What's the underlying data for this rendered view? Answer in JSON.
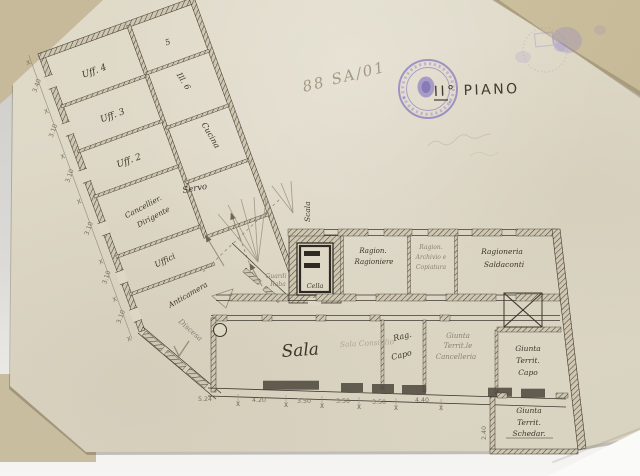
{
  "photo": {
    "backdrop": "#d4d2ce",
    "paper": "#ddd7c6",
    "backing": "#c7ba9a",
    "stamp_color": "#7e6fc2",
    "ink_color": "#3e3930",
    "pencil_color": "#8b8271"
  },
  "annotations": {
    "floor_title": "II° PIANO",
    "pencil_number": "88 SA/01",
    "tick": "X"
  },
  "plan": {
    "left_wing": {
      "rooms_left": [
        "Uff. 4",
        "Uff. 3",
        "Uff. 2"
      ],
      "office_room": {
        "line1": "Cancellier.",
        "line2": "Dirigente"
      },
      "offices_label": "Uffici",
      "anteroom_label": "Anticamera",
      "rooms_right": {
        "r1": "5",
        "r2": "Ill. 6",
        "r3": "Cucina",
        "r4": "Servo"
      },
      "dimensions": [
        "3.40",
        "3.10",
        "3.10",
        "3.10",
        "3.10",
        "3.10"
      ]
    },
    "center": {
      "stairs": "Scala",
      "cell": "Cella",
      "wardrobe1": "Guardi",
      "wardrobe2": "Roba",
      "descent": "Discesa"
    },
    "accounting": {
      "room1": {
        "line1": "Ragion.",
        "line2": "Ragioniere"
      },
      "room2": {
        "line1": "Ragion.",
        "line2": "Archivio e",
        "line3": "Copiatura"
      },
      "room3": {
        "line1": "Ragioneria",
        "line2": "Saldaconti"
      }
    },
    "hall": {
      "name": "Sala",
      "pencil_note": "Sala Consiglio",
      "chief": {
        "line1": "Rag.",
        "line2": "Capo"
      }
    },
    "giunta": {
      "room1": {
        "line1": "Giunta",
        "line2": "Territ.le",
        "line3": "Cancelleria"
      },
      "room2": {
        "line1": "Giunta",
        "line2": "Territ.",
        "line3": "Capo"
      },
      "room3": {
        "line1": "Giunta",
        "line2": "Territ.",
        "line3": "Schedar."
      }
    },
    "dimensions_bottom": [
      "5.24",
      "4.20",
      "3.50",
      "3.50",
      "3.50",
      "4.40"
    ],
    "dimension_annex": "2.40"
  }
}
